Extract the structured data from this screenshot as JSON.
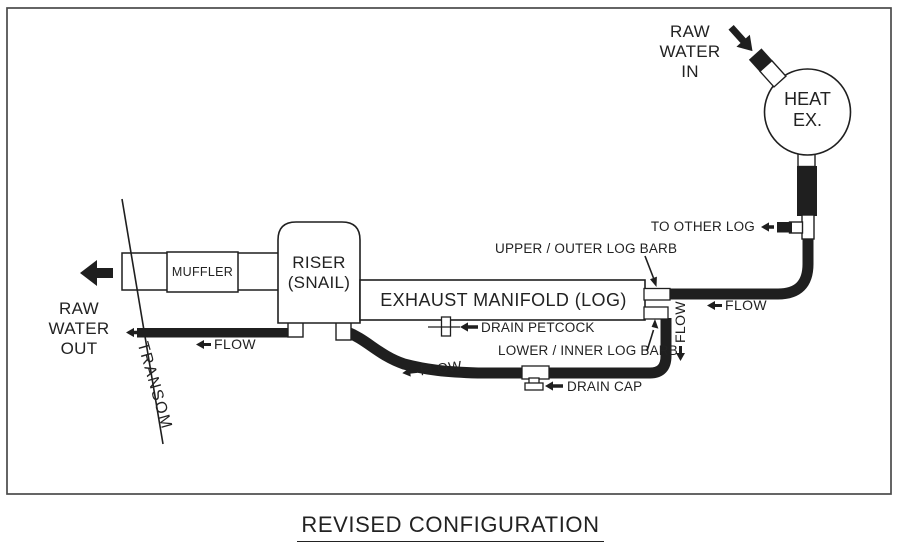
{
  "title": "REVISED CONFIGURATION",
  "colors": {
    "ink": "#1f1f1f",
    "paper": "#ffffff"
  },
  "labels": {
    "raw_water_in": [
      "RAW",
      "WATER",
      "IN"
    ],
    "heat_exchanger": [
      "HEAT",
      "EX."
    ],
    "to_other_log": "TO OTHER LOG",
    "upper_log_barb": "UPPER / OUTER LOG BARB",
    "lower_log_barb": "LOWER / INNER LOG BARB",
    "exhaust_manifold": "EXHAUST MANIFOLD (LOG)",
    "riser": [
      "RISER",
      "(SNAIL)"
    ],
    "muffler": "MUFFLER",
    "raw_water_out": [
      "RAW",
      "WATER",
      "OUT"
    ],
    "transom": "TRANSOM",
    "drain_petcock": "DRAIN PETCOCK",
    "drain_cap": "DRAIN CAP",
    "flow": "FLOW"
  }
}
